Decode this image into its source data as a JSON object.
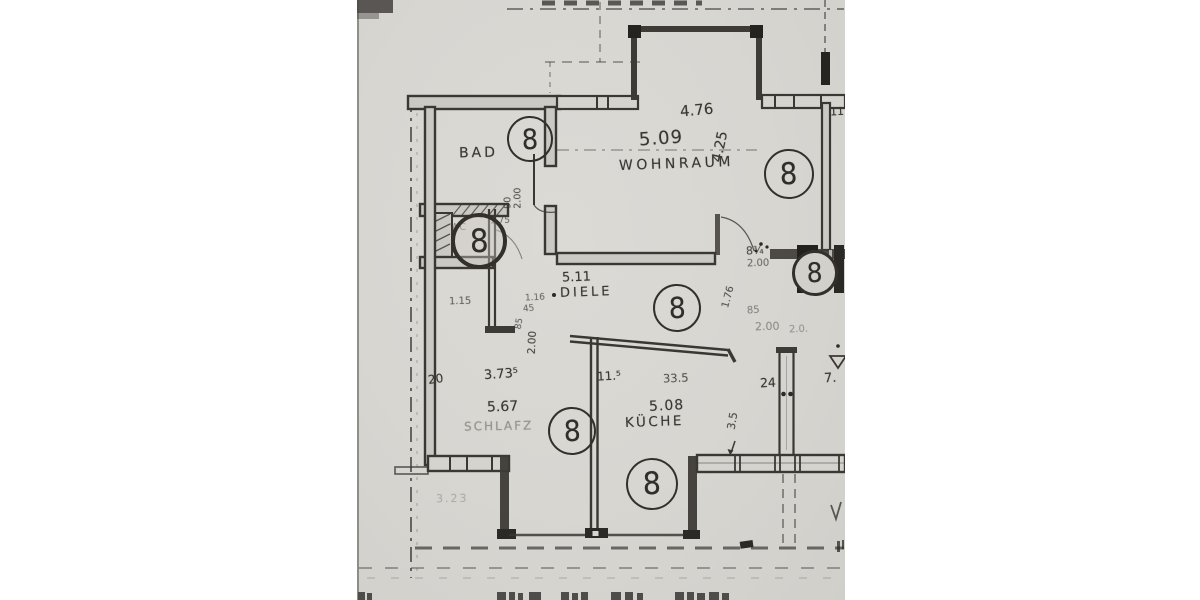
{
  "paper": {
    "background": "#d8d6d1",
    "ink": "#3a3733"
  },
  "marker": {
    "symbol": "8",
    "count": 7
  },
  "rooms": [
    {
      "key": "bad",
      "label": "BAD",
      "area": null
    },
    {
      "key": "wohnraum",
      "label": "WOHNRAUM",
      "area": "5.09"
    },
    {
      "key": "diele",
      "label": "DIELE",
      "area": "5.11"
    },
    {
      "key": "schlafzimmer",
      "label": "SCHLAFZ",
      "area": "5.67"
    },
    {
      "key": "kueche",
      "label": "KÜCHE",
      "area": "5.08"
    }
  ],
  "dims": {
    "w476": "4.76",
    "w425": "4.25",
    "w373": "3.73⁵",
    "w115": "11.⁵",
    "w335": "33.5",
    "w20": "20",
    "w24": "24",
    "w7": "7.",
    "w11": "11.",
    "door_wc_w": "90",
    "door_wc_h": "2.00",
    "niche_115": "1.15",
    "wc_175": "1.75",
    "d116": "1.16",
    "d45": "45",
    "d85": "85",
    "d200": "2.00",
    "door_wr_w": "8¾",
    "door_wr_h": "2.00",
    "door_wr_176": "1.76",
    "s85": "85",
    "s200": "2.00",
    "s20": "2.0.",
    "k35": "3.5",
    "faint_323": "3.23"
  },
  "misc": {
    "wc": "WC"
  }
}
